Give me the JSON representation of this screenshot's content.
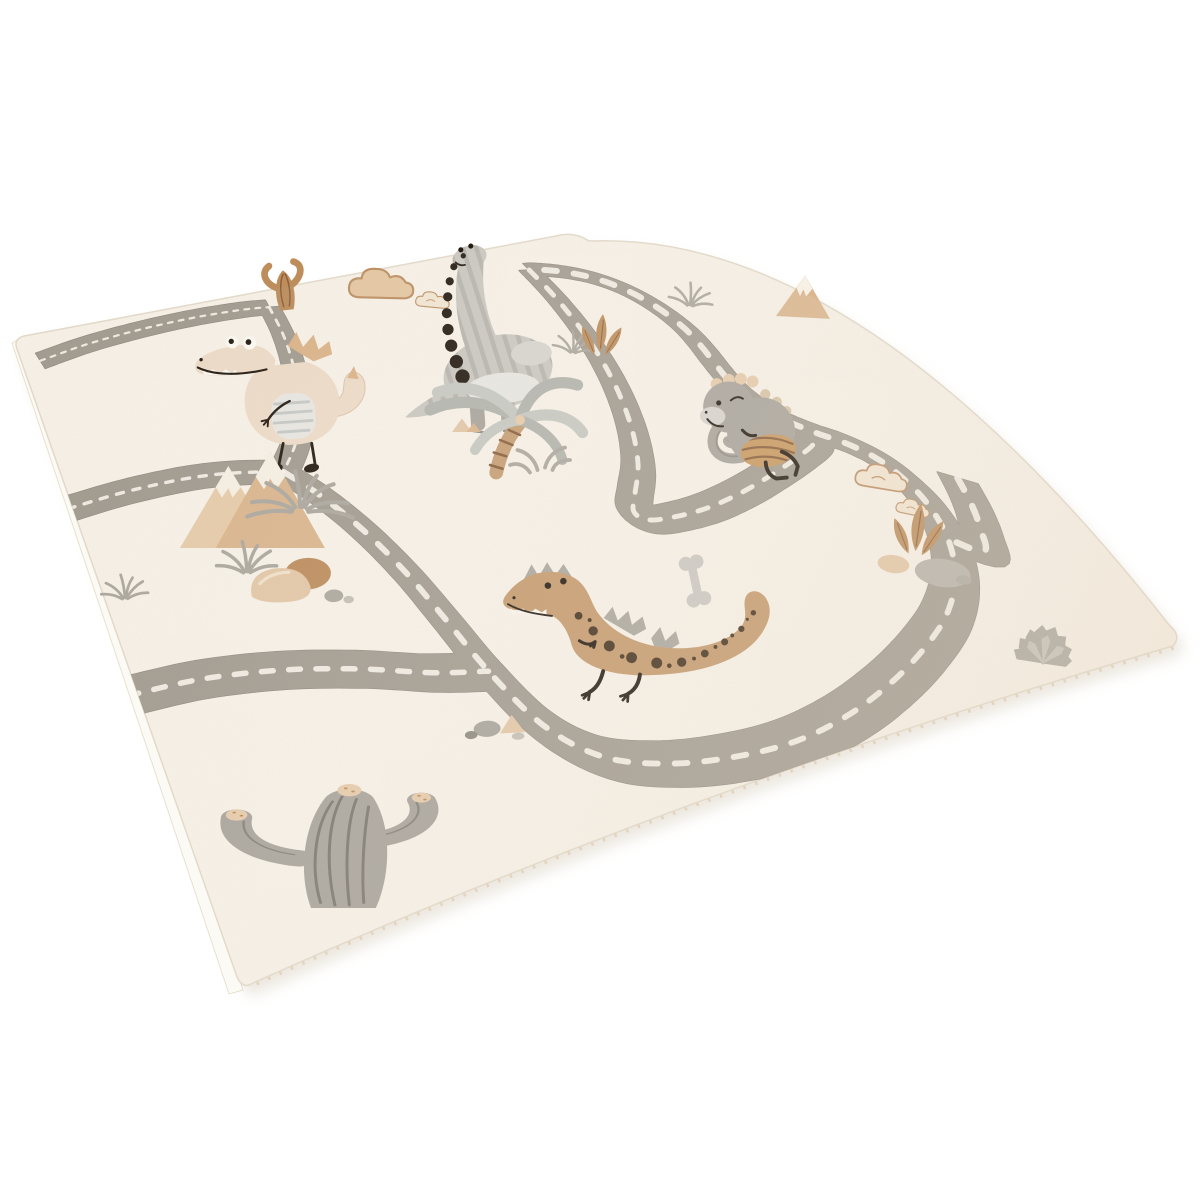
{
  "scene": {
    "type": "product-photo",
    "subject": "children's dinosaur road play rug shown in perspective on a white background",
    "background_color": "#ffffff",
    "rug_base_color": "#f8f2e8",
    "no_visible_text": true
  },
  "palette": {
    "bg": "#ffffff",
    "rug": "#f8f2e8",
    "rugFar": "#e9d9c2",
    "road": "#a39c91",
    "roadEdge": "#8c857b",
    "dash": "#f7f3ea",
    "selvedge": "#fcfaf4",
    "edgeLine": "#e3daca",
    "shadowCol": "#ddd4c5",
    "fringe": "#dcc1a0",
    "beige": "#eedcc8",
    "tan": "#dcb489",
    "brown": "#bd8d5c",
    "brownDark": "#8a5f3a",
    "trex": "#c69b6e",
    "trexSpot": "#46321f",
    "gray1": "#cbc8c2",
    "gray2": "#a9a49c",
    "grayLight": "#d8d5cf",
    "grayDark": "#6e6a62",
    "belly": "#e9e7e2",
    "black": "#241b12",
    "white": "#fdfaf4",
    "mount": "#dbb68e",
    "mountLight": "#e7ccab",
    "cap": "#f7f0e4",
    "rock": "#b6b2aa",
    "rockBeige": "#e4c8a7",
    "grass": "#aca89f",
    "bone": "#ccc9c3",
    "shell": "#c9995f",
    "cloudFill": "#e6c8a2",
    "cloudFill2": "#f3e7d3",
    "cloudLine": "#bd8f63",
    "lnStripe": "#b2afa9",
    "trunk": "#c69e74",
    "frond1": "#b3b5ae",
    "frond2": "#c7c9c2",
    "legLine": "#8f8b84"
  },
  "layout_hints": {
    "rug_screen_corners": {
      "left": [
        24,
        336
      ],
      "top": [
        573,
        233
      ],
      "right": [
        1177,
        637
      ],
      "bottom": [
        245,
        987
      ]
    },
    "homography": {
      "a": 635.4,
      "b": 92.6,
      "c": 25,
      "d": -73.7,
      "e": 139.2,
      "f": 340,
      "g": 0.1526,
      "h": -0.516
    },
    "flat_design_size": [
      1000,
      700
    ],
    "road_halfwidth": 17
  },
  "rug_design": {
    "roads": [
      {
        "name": "top-edge-road",
        "pts": [
          [
            12,
            48
          ],
          [
            90,
            34
          ],
          [
            180,
            26
          ],
          [
            270,
            24
          ],
          [
            350,
            28
          ],
          [
            392,
            34
          ]
        ]
      },
      {
        "name": "descender-road",
        "pts": [
          [
            392,
            34
          ],
          [
            382,
            92
          ],
          [
            364,
            152
          ],
          [
            338,
            214
          ],
          [
            300,
            270
          ],
          [
            258,
            310
          ]
        ]
      },
      {
        "name": "left-spur-road",
        "pts": [
          [
            -16,
            290
          ],
          [
            60,
            286
          ],
          [
            140,
            288
          ],
          [
            200,
            296
          ],
          [
            258,
            310
          ]
        ]
      },
      {
        "name": "main-loop-road",
        "pts": [
          [
            258,
            310
          ],
          [
            284,
            352
          ],
          [
            306,
            404
          ],
          [
            320,
            458
          ],
          [
            327,
            510
          ],
          [
            333,
            562
          ],
          [
            347,
            612
          ],
          [
            378,
            645
          ],
          [
            428,
            663
          ],
          [
            488,
            673
          ],
          [
            552,
            677
          ],
          [
            618,
            673
          ],
          [
            684,
            663
          ],
          [
            748,
            649
          ],
          [
            812,
            630
          ],
          [
            868,
            604
          ],
          [
            912,
            572
          ],
          [
            942,
            536
          ],
          [
            955,
            505
          ],
          [
            958,
            478
          ],
          [
            948,
            452
          ],
          [
            930,
            430
          ],
          [
            915,
            405
          ],
          [
            908,
            375
          ],
          [
            912,
            342
          ],
          [
            925,
            310
          ],
          [
            940,
            278
          ],
          [
            952,
            245
          ],
          [
            957,
            210
          ],
          [
            955,
            175
          ],
          [
            945,
            142
          ],
          [
            925,
            112
          ],
          [
            895,
            88
          ],
          [
            862,
            72
          ],
          [
            845,
            68
          ]
        ]
      },
      {
        "name": "s-curve-road",
        "pts": [
          [
            845,
            68
          ],
          [
            832,
            130
          ],
          [
            812,
            195
          ],
          [
            786,
            258
          ],
          [
            755,
            315
          ],
          [
            718,
            368
          ],
          [
            678,
            412
          ],
          [
            640,
            442
          ],
          [
            618,
            460
          ],
          [
            622,
            472
          ],
          [
            648,
            477
          ],
          [
            700,
            478
          ],
          [
            760,
            472
          ],
          [
            820,
            462
          ],
          [
            870,
            452
          ],
          [
            910,
            442
          ],
          [
            930,
            430
          ]
        ]
      },
      {
        "name": "lower-left-road",
        "pts": [
          [
            -16,
            496
          ],
          [
            60,
            500
          ],
          [
            140,
            512
          ],
          [
            215,
            530
          ],
          [
            280,
            550
          ],
          [
            333,
            562
          ]
        ]
      },
      {
        "name": "corner-spur-road",
        "pts": [
          [
            1015,
            520
          ],
          [
            988,
            548
          ],
          [
            960,
            572
          ],
          [
            930,
            592
          ],
          [
            912,
            572
          ]
        ]
      }
    ],
    "elements": [
      {
        "type": "smallcactus",
        "name": "brown-cactus",
        "x": 287,
        "y": 310,
        "s": 0.95,
        "r": -6
      },
      {
        "type": "cloud",
        "name": "beige-cloud",
        "x": 390,
        "y": 291,
        "s": 1.05,
        "r": 0
      },
      {
        "type": "cloud2",
        "name": "small-cloud",
        "x": 437,
        "y": 304,
        "s": 0.55,
        "r": 4
      },
      {
        "type": "longneck",
        "name": "long-neck-dinosaur",
        "x": 498,
        "y": 372,
        "s": 1.02,
        "r": -4
      },
      {
        "type": "smallmount",
        "name": "small-mountain",
        "x": 776,
        "y": 316,
        "s": 1,
        "r": 3
      },
      {
        "type": "grass",
        "name": "grass-tuft-top-right",
        "x": 690,
        "y": 305,
        "s": 0.85,
        "r": 8
      },
      {
        "type": "grass",
        "name": "grass-tuft-by-neck",
        "x": 573,
        "y": 352,
        "s": 0.8,
        "r": 6
      },
      {
        "type": "leftdino",
        "name": "crocodile-dinosaur",
        "x": 295,
        "y": 395,
        "s": 0.95,
        "r": -4
      },
      {
        "type": "dunes",
        "name": "sand-dunes",
        "x": 452,
        "y": 432,
        "s": 0.9,
        "r": 0
      },
      {
        "type": "fern",
        "name": "brown-fern",
        "x": 600,
        "y": 352,
        "s": 1,
        "r": 6
      },
      {
        "type": "palm",
        "name": "palm-tree",
        "x": 500,
        "y": 470,
        "s": 1.25,
        "r": 0
      },
      {
        "type": "graydino",
        "name": "gray-dinosaur",
        "x": 746,
        "y": 427,
        "s": 0.85,
        "r": 4
      },
      {
        "type": "mountains",
        "name": "beige-mountains",
        "x": 180,
        "y": 548,
        "s": 1.05,
        "r": 0
      },
      {
        "type": "grasswide",
        "name": "wide-grass-tuft",
        "x": 300,
        "y": 507,
        "s": 1.2,
        "r": 0
      },
      {
        "type": "rocks",
        "name": "rock-cluster",
        "x": 283,
        "y": 585,
        "s": 1.05,
        "r": -2
      },
      {
        "type": "grass",
        "name": "grass-tuft-left-edge",
        "x": 125,
        "y": 598,
        "s": 0.9,
        "r": -4
      },
      {
        "type": "cloud2",
        "name": "cloud-doodle-right-1",
        "x": 888,
        "y": 484,
        "s": 0.85,
        "r": 8
      },
      {
        "type": "cloud2",
        "name": "cloud-doodle-right-2",
        "x": 917,
        "y": 512,
        "s": 0.55,
        "r": 10
      },
      {
        "type": "fireplant",
        "name": "fire-plant-and-rocks",
        "x": 922,
        "y": 562,
        "s": 1,
        "r": 8
      },
      {
        "type": "bone",
        "name": "bone",
        "x": 695,
        "y": 581,
        "s": 0.78,
        "r": 78
      },
      {
        "type": "trex",
        "name": "t-rex-dinosaur",
        "x": 645,
        "y": 640,
        "s": 0.78,
        "r": -2
      },
      {
        "type": "rockssmall",
        "name": "small-rocks",
        "x": 487,
        "y": 727,
        "s": 0.9,
        "r": -3
      },
      {
        "type": "agave",
        "name": "agave-plant",
        "x": 1043,
        "y": 663,
        "s": 1,
        "r": 6
      },
      {
        "type": "bigcactus",
        "name": "saguaro-cactus",
        "x": 335,
        "y": 908,
        "sx": 1.2,
        "sy": 0.62,
        "r": 0
      }
    ]
  }
}
